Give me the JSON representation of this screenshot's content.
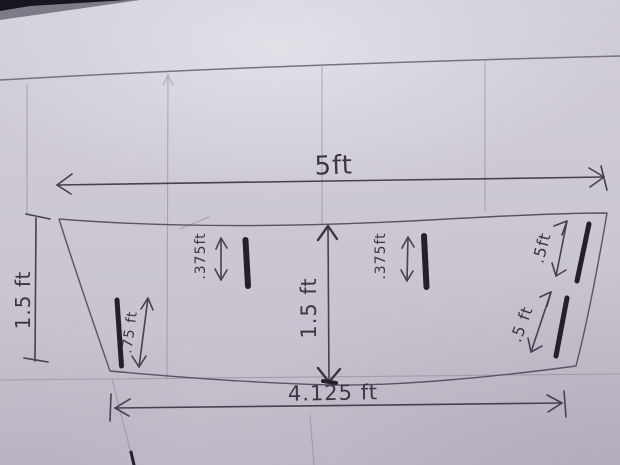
{
  "photo": {
    "subject": "hand-drawn dimensioned sketch of a tapered panel on paper",
    "units": "ft",
    "colors": {
      "paper": "#cbc6d2",
      "pencil_guide": "#8b8494",
      "ink": "#3b3544",
      "thick_marker": "#241f2b",
      "table_background": "#14141f"
    }
  },
  "dimensions": {
    "top_width": {
      "label": "5ft",
      "value": 5,
      "unit": "ft"
    },
    "bottom_width": {
      "label": "4.125 ft",
      "value": 4.125,
      "unit": "ft"
    },
    "left_height": {
      "label": "1.5 ft",
      "value": 1.5,
      "unit": "ft"
    },
    "center_height": {
      "label": "1.5 ft",
      "value": 1.5,
      "unit": "ft"
    },
    "left_slot": {
      "label": ".375ft",
      "value": 0.375,
      "unit": "ft"
    },
    "right_slot": {
      "label": ".375ft",
      "value": 0.375,
      "unit": "ft"
    },
    "bottom_left_inset": {
      "label": ".75 ft",
      "value": 0.75,
      "unit": "ft"
    },
    "right_edge_top_inset": {
      "label": ".5ft",
      "value": 0.5,
      "unit": "ft"
    },
    "right_edge_bottom_inset": {
      "label": ".5 ft",
      "value": 0.5,
      "unit": "ft"
    }
  }
}
